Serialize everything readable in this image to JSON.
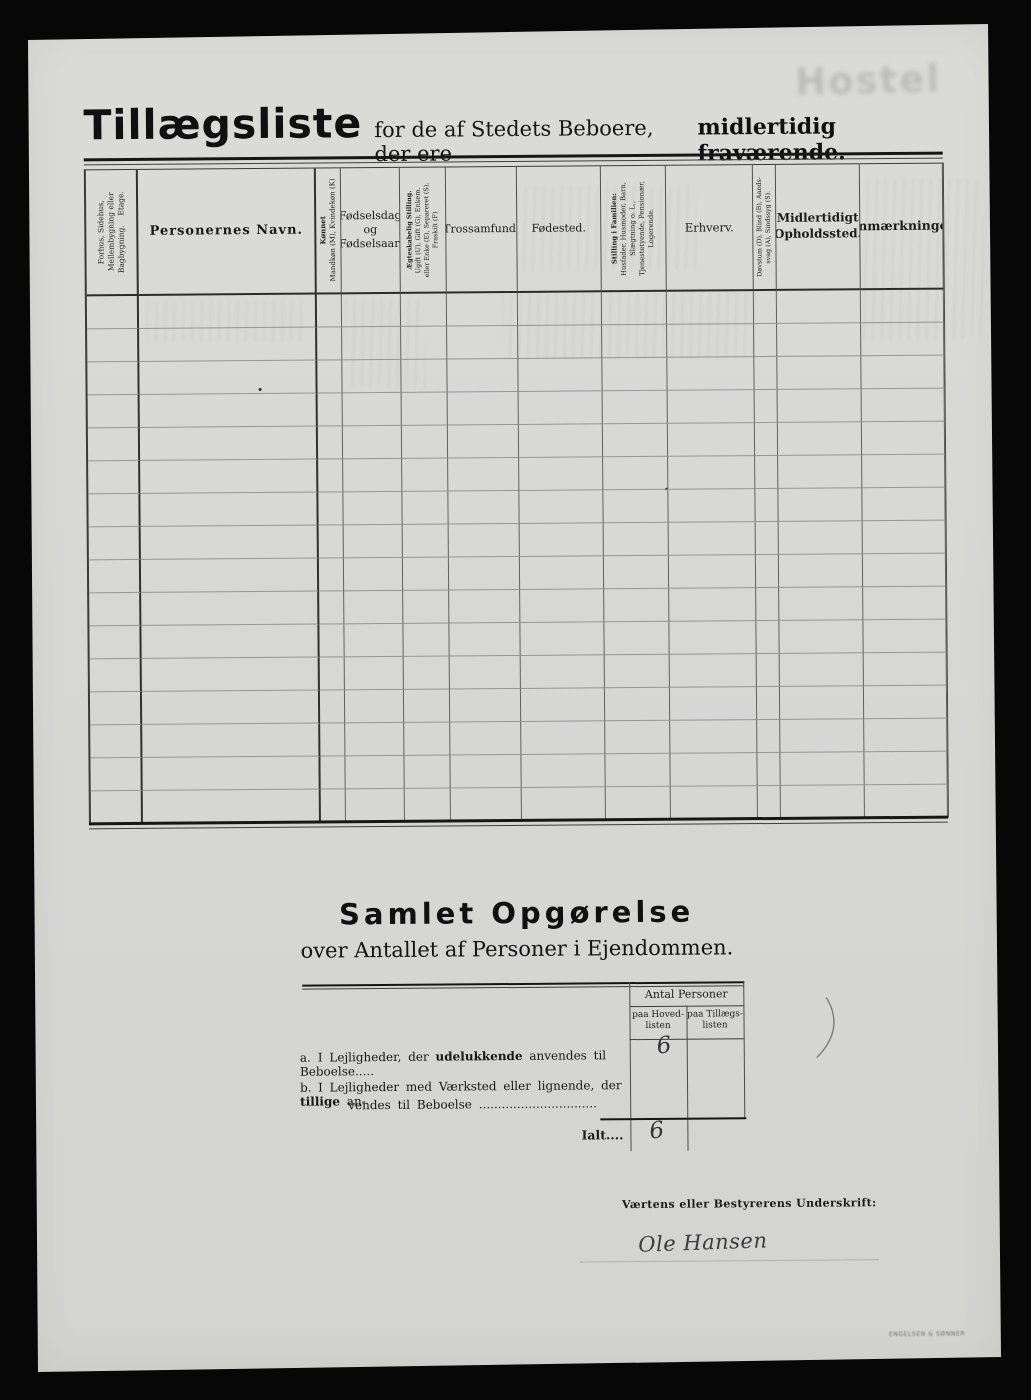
{
  "page": {
    "title": "Tillægsliste",
    "subtitle_regular": "for de af Stedets Beboere, der ere",
    "subtitle_bold": "midlertidig fraværende.",
    "ghost_bleedthrough_text": "Hostel",
    "printer_mark": "Engelsen & Sønner"
  },
  "table": {
    "columns": [
      {
        "lines": [
          "Forhus, Sidehus,",
          "Mellembygning eller",
          "Bagbygning.    Etage."
        ],
        "rotated": true,
        "bold": false,
        "bold_first": false
      },
      {
        "lines": [
          "Personernes Navn."
        ],
        "rotated": false,
        "bold": true,
        "bold_first": false
      },
      {
        "lines": [
          "Kønnet",
          "Mandkøn (M), Kvindekøn (K)"
        ],
        "rotated": true,
        "bold": false,
        "bold_first": true
      },
      {
        "lines": [
          "Fødselsdag",
          "og",
          "Fødselsaar."
        ],
        "rotated": false,
        "bold": false,
        "bold_first": false
      },
      {
        "lines": [
          "Ægteskabelig Stilling.",
          "Ugift (U), Gift (G), Enkem.",
          "eller Enke (E), Separeret (S),",
          "Fraskilt (F)"
        ],
        "rotated": true,
        "bold": false,
        "bold_first": true
      },
      {
        "lines": [
          "Trossamfund."
        ],
        "rotated": false,
        "bold": false,
        "bold_first": false
      },
      {
        "lines": [
          "Fødested."
        ],
        "rotated": false,
        "bold": false,
        "bold_first": false
      },
      {
        "lines": [
          "Stilling i Familien:",
          "Husfader, Husmoder, Barn,",
          "Slægtning o. L.,",
          "Tjenestetyende, Pensionær,",
          "Logerende."
        ],
        "rotated": true,
        "bold": false,
        "bold_first": true
      },
      {
        "lines": [
          "Erhverv."
        ],
        "rotated": false,
        "bold": false,
        "bold_first": false
      },
      {
        "lines": [
          "Døvstum (D), Blind (B), Aands-",
          "svag (A), Sindssyg (S)."
        ],
        "rotated": true,
        "bold": false,
        "bold_first": false
      },
      {
        "lines": [
          "Midlertidigt",
          "Opholdssted."
        ],
        "rotated": false,
        "bold": true,
        "bold_first": false
      },
      {
        "lines": [
          "Anmærkninger"
        ],
        "rotated": false,
        "bold": true,
        "bold_first": false
      }
    ],
    "body_rows": 16
  },
  "summary": {
    "heading": "Samlet Opgørelse",
    "subheading": "over Antallet af Personer i Ejendommen.",
    "antal_header": "Antal Personer",
    "col_hoved": "paa Hoved-\nlisten",
    "col_tillaegs": "paa Tillægs-\nlisten",
    "row_a_prefix": "a.",
    "row_a_text1": "I Lejligheder, der ",
    "row_a_bold": "udelukkende",
    "row_a_text2": " anvendes til Beboelse.....",
    "row_b_prefix": "b.",
    "row_b_text1": "I Lejligheder med Værksted eller lignende, der ",
    "row_b_bold": "tillige",
    "row_b_text2": " an-",
    "row_b_line2": "vendes til Beboelse ...............................",
    "value_hovedlisten_a": "6",
    "total_label": "Ialt....",
    "total_value": "6"
  },
  "signature": {
    "label": "Værtens eller Bestyrerens Underskrift:",
    "name": "Ole Hansen"
  }
}
